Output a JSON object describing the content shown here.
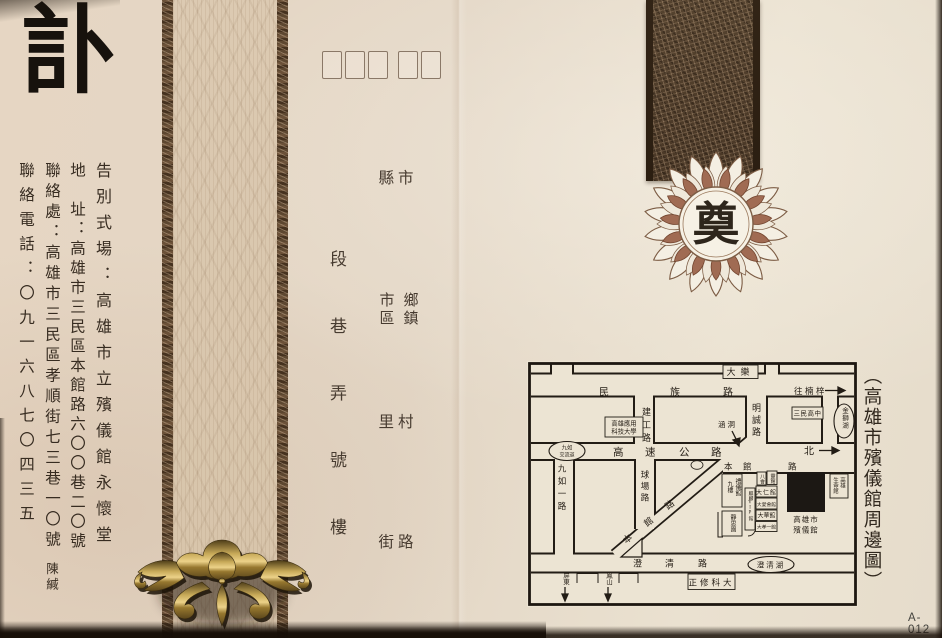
{
  "card": {
    "obituary_title": "訃",
    "code_label": "A-012"
  },
  "left_info": {
    "funeral_venue": "告別式場：高雄市立殯儀館永懷堂",
    "address": "地　址：高雄市三民區本館路六〇〇巷二〇號",
    "contact_place": "聯絡處：高雄市三民區孝順街七三巷一〇號",
    "contact_name": "陳緘",
    "contact_phone": "聯絡電話：〇九一六八七〇四三五"
  },
  "address_form": {
    "county_city": "縣市",
    "district": "市區",
    "township": "鄉鎮",
    "village": "里村",
    "street_road": "街路",
    "section_column": "段巷弄號樓"
  },
  "seal": {
    "char": "奠"
  },
  "map": {
    "title": "（高雄市殯儀館周邊圖）",
    "roads": {
      "minzu": "民族路",
      "jiangong": "建工路",
      "mingcheng": "明誠路",
      "freeway": "高速公路",
      "benguan": "本館路",
      "jiuru_first": "九如一路",
      "qiuchang": "球場路",
      "chengqing": "澄清路"
    },
    "places": {
      "dale": "大樂",
      "kuas_line1": "高雄應用",
      "kuas_line2": "科技大學",
      "sanmin_hs": "三民高中",
      "jinshi_lake": "金獅湖",
      "ic_line1": "九如",
      "ic_line2": "交流道",
      "culvert": "涵洞",
      "chengqing_lake": "澄清湖",
      "chengshiu": "正修科大",
      "funeral_line1": "高雄市",
      "funeral_line2": "殯儀館",
      "life_col_r": "高雄",
      "life_col_l": "生命館",
      "ritual_col_r": "禮儀館",
      "ritual_col_l": "九樓",
      "jingsi": "靜思園",
      "vip": "麒麟VIP館",
      "mini_1": "八會",
      "mini_2": "靈館",
      "daren": "大仁館",
      "daai": "大愛會館",
      "dahua": "大華館",
      "daxiao": "大孝一館"
    },
    "directions": {
      "to_nanzi": "往楠梓",
      "north": "北",
      "pingtung": "屏東",
      "fengshan": "鳳山"
    }
  },
  "colors": {
    "paper": "#e6d9c7",
    "ink": "#362c21",
    "band_dark": "#4a3827",
    "gold": "#c7a958",
    "petal_red": "#a06b53"
  }
}
